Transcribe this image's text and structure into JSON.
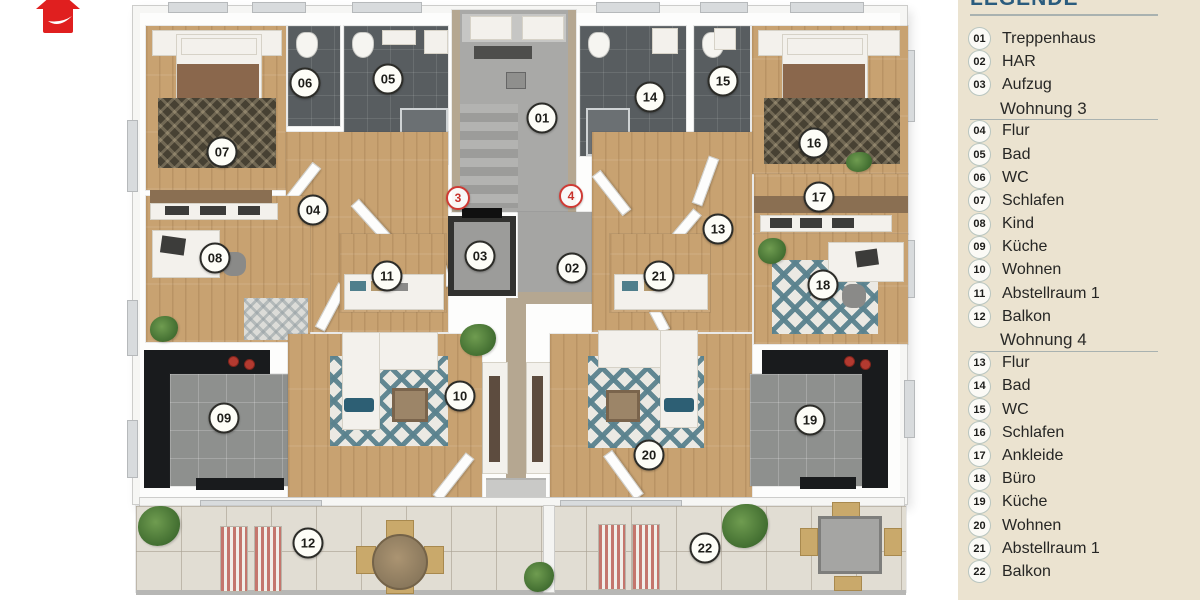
{
  "logo": {
    "name": "red house logo",
    "color": "#e01f1f"
  },
  "legend": {
    "title": "LEGENDE",
    "title_color": "#2a5c7e",
    "background": "#ebe3d0",
    "rows": [
      {
        "num": "01",
        "label": "Treppenhaus"
      },
      {
        "num": "02",
        "label": "HAR"
      },
      {
        "num": "03",
        "label": "Aufzug"
      },
      {
        "header": "Wohnung 3"
      },
      {
        "num": "04",
        "label": "Flur"
      },
      {
        "num": "05",
        "label": "Bad"
      },
      {
        "num": "06",
        "label": "WC"
      },
      {
        "num": "07",
        "label": "Schlafen"
      },
      {
        "num": "08",
        "label": "Kind"
      },
      {
        "num": "09",
        "label": "Küche"
      },
      {
        "num": "10",
        "label": "Wohnen"
      },
      {
        "num": "11",
        "label": "Abstellraum 1"
      },
      {
        "num": "12",
        "label": "Balkon"
      },
      {
        "header": "Wohnung 4"
      },
      {
        "num": "13",
        "label": "Flur"
      },
      {
        "num": "14",
        "label": "Bad"
      },
      {
        "num": "15",
        "label": "WC"
      },
      {
        "num": "16",
        "label": "Schlafen"
      },
      {
        "num": "17",
        "label": "Ankleide"
      },
      {
        "num": "18",
        "label": "Büro"
      },
      {
        "num": "19",
        "label": "Küche"
      },
      {
        "num": "20",
        "label": "Wohnen"
      },
      {
        "num": "21",
        "label": "Abstellraum 1"
      },
      {
        "num": "22",
        "label": "Balkon"
      }
    ]
  },
  "plan": {
    "markers": [
      {
        "num": "01"
      },
      {
        "num": "02"
      },
      {
        "num": "03"
      },
      {
        "num": "04"
      },
      {
        "num": "05"
      },
      {
        "num": "06"
      },
      {
        "num": "07"
      },
      {
        "num": "08"
      },
      {
        "num": "09"
      },
      {
        "num": "10"
      },
      {
        "num": "11"
      },
      {
        "num": "12"
      },
      {
        "num": "13"
      },
      {
        "num": "14"
      },
      {
        "num": "15"
      },
      {
        "num": "16"
      },
      {
        "num": "17"
      },
      {
        "num": "18"
      },
      {
        "num": "19"
      },
      {
        "num": "20"
      },
      {
        "num": "21"
      },
      {
        "num": "22"
      }
    ],
    "unit_markers": [
      {
        "num": "3"
      },
      {
        "num": "4"
      }
    ],
    "colors": {
      "wood_floor": "#c8a271",
      "bath_tile": "#585d60",
      "kitchen_tile": "#8e908e",
      "balcony_tile": "#e1ddd3",
      "rug_teal": "#56828f",
      "wall_tan": "#b5a791",
      "counter_black": "#191b1d",
      "accent_red": "#cf3a34"
    }
  }
}
